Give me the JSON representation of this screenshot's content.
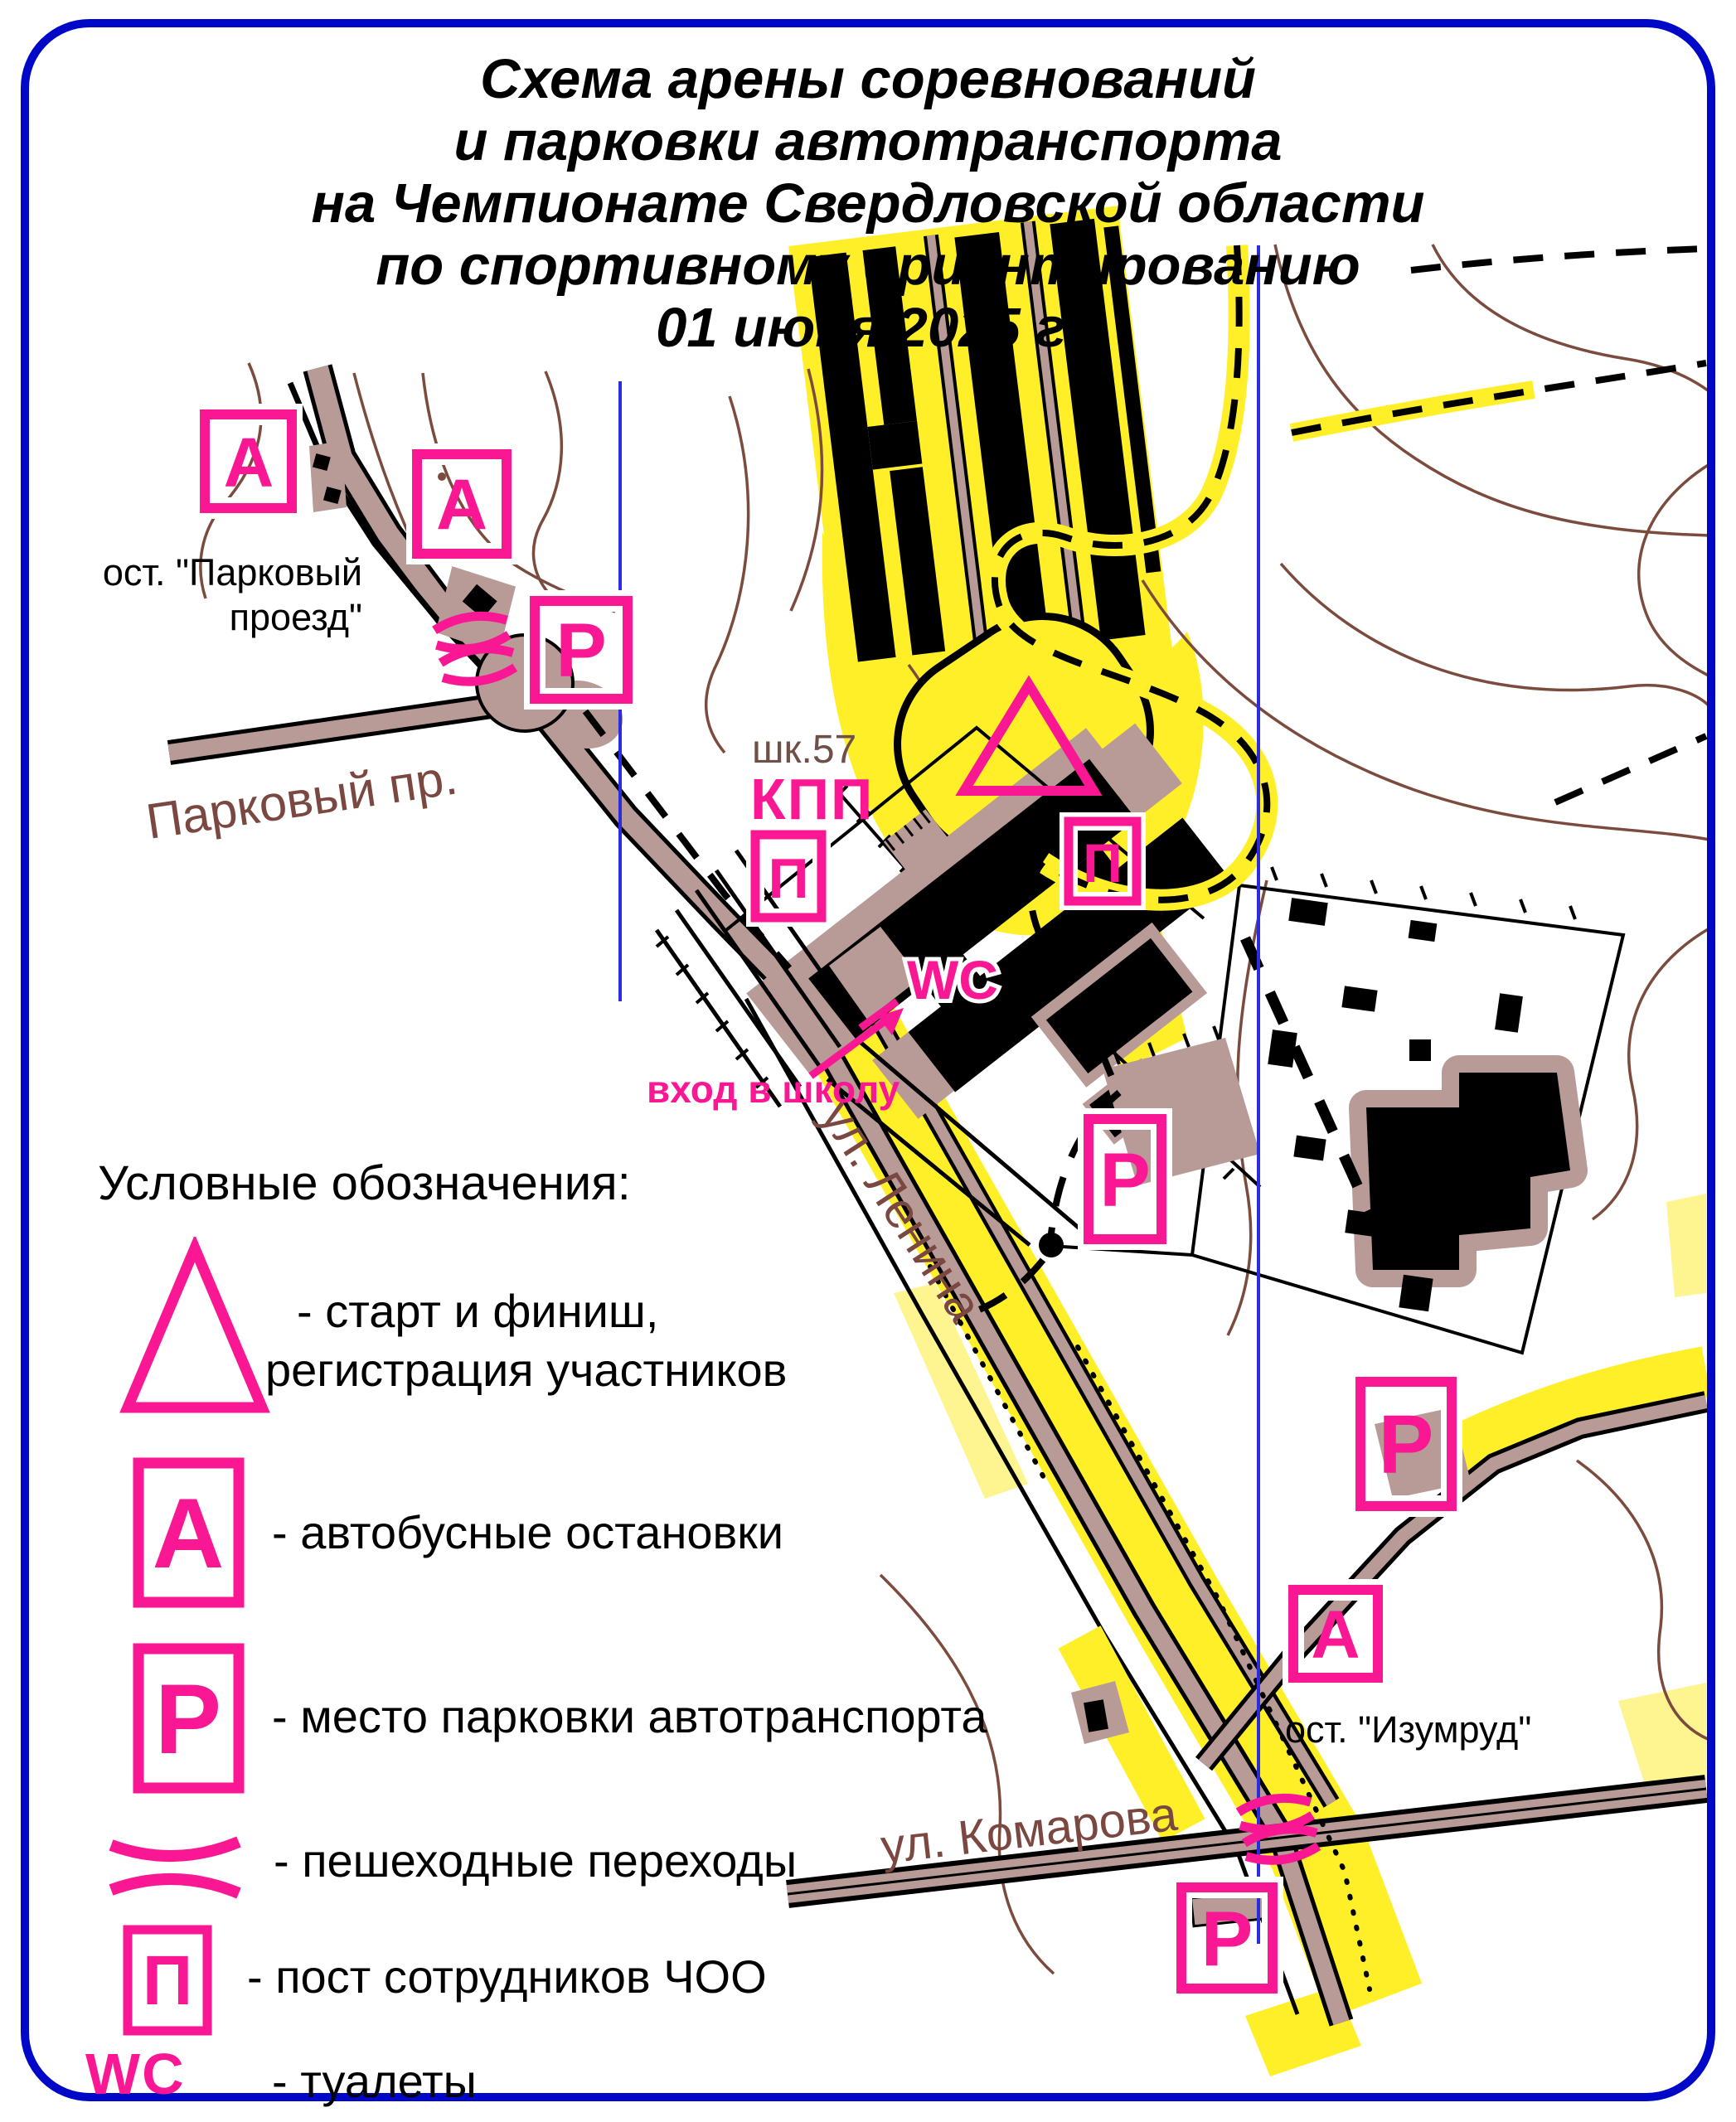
{
  "title": {
    "line1": "Схема арены соревнований",
    "line2": "и парковки автотранспорта",
    "line3": "на Чемпионате Свердловской области",
    "line4": "по спортивному ориентированию",
    "line5": "01 июня 2025 г."
  },
  "map": {
    "marker_letters": {
      "bus_stop": "А",
      "parking": "Р",
      "security_post": "П"
    },
    "labels": {
      "school": "шк.57",
      "checkpoint": "КПП",
      "wc": "WC",
      "school_entrance": "вход в школу",
      "stop_parkovy_line1": "ост. \"Парковый",
      "stop_parkovy_line2": "проезд\"",
      "stop_izumrud": "ост. \"Изумруд\"",
      "street_parkovy": "Парковый пр.",
      "street_lenina": "ул. Ленина",
      "street_komarova": "ул. Комарова"
    }
  },
  "legend": {
    "heading": "Условные обозначения:",
    "items": [
      {
        "symbol": "start-finish-triangle",
        "letter": "",
        "label_line1": "- старт и финиш,",
        "label_line2": "регистрация участников"
      },
      {
        "symbol": "bus-stop",
        "letter": "А",
        "label": "- автобусные остановки"
      },
      {
        "symbol": "parking",
        "letter": "Р",
        "label": "- место парковки автотранспорта"
      },
      {
        "symbol": "pedestrian-crossing",
        "letter": "",
        "label": "- пешеходные переходы"
      },
      {
        "symbol": "security-post",
        "letter": "П",
        "label": "- пост сотрудников ЧОО"
      },
      {
        "symbol": "toilets",
        "letter": "WC",
        "label": "- туалеты"
      }
    ]
  },
  "colors": {
    "accent_pink": "#fa1793",
    "border_blue": "#0008c8",
    "meridian_blue": "#2b2bdf",
    "road_tan": "#b89a96",
    "open_yellow": "#ffef28",
    "rough_yellow": "#fff590",
    "contour_brown": "#7b4b3d",
    "street_text_brown": "#7a4840"
  }
}
